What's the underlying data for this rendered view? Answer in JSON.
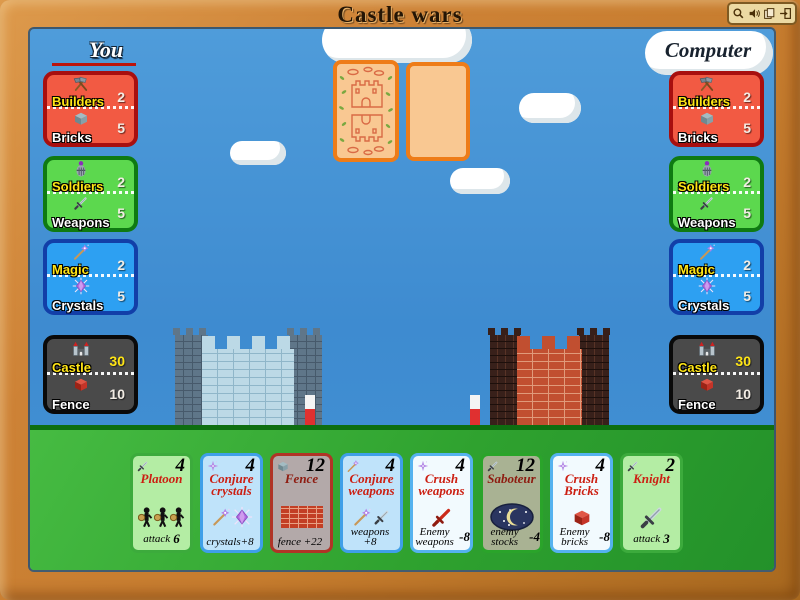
{
  "window": {
    "title": "Castle wars",
    "toolbar": {
      "zoom_icon": "magnifier",
      "sound_icon": "speaker",
      "pages_icon": "pages",
      "exit_icon": "exit-door"
    }
  },
  "players": {
    "you": {
      "name": "You",
      "panels": [
        {
          "icon_top": "builders-hammers-icon",
          "label_top": "Builders",
          "value_top": "2",
          "icon_bottom": "brick-icon",
          "label_bottom": "Bricks",
          "value_bottom": "5"
        },
        {
          "icon_top": "knight-helmet-icon",
          "label_top": "Soldiers",
          "value_top": "2",
          "icon_bottom": "sword-icon",
          "label_bottom": "Weapons",
          "value_bottom": "5"
        },
        {
          "icon_top": "magic-wand-icon",
          "label_top": "Magic",
          "value_top": "2",
          "icon_bottom": "crystal-icon",
          "label_bottom": "Crystals",
          "value_bottom": "5"
        },
        {
          "icon_top": "castle-icon",
          "label_top": "Castle",
          "value_top": "30",
          "icon_bottom": "fence-brick-icon",
          "label_bottom": "Fence",
          "value_bottom": "10"
        }
      ]
    },
    "computer": {
      "name": "Computer",
      "panels": [
        {
          "icon_top": "builders-hammers-icon",
          "label_top": "Builders",
          "value_top": "2",
          "icon_bottom": "brick-icon",
          "label_bottom": "Bricks",
          "value_bottom": "5"
        },
        {
          "icon_top": "knight-helmet-icon",
          "label_top": "Soldiers",
          "value_top": "2",
          "icon_bottom": "sword-icon",
          "label_bottom": "Weapons",
          "value_bottom": "5"
        },
        {
          "icon_top": "magic-wand-icon",
          "label_top": "Magic",
          "value_top": "2",
          "icon_bottom": "crystal-icon",
          "label_bottom": "Crystals",
          "value_bottom": "5"
        },
        {
          "icon_top": "castle-icon",
          "label_top": "Castle",
          "value_top": "30",
          "icon_bottom": "fence-brick-icon",
          "label_bottom": "Fence",
          "value_bottom": "10"
        }
      ]
    }
  },
  "hand": {
    "cards": [
      {
        "title": "Platoon",
        "cost": "4",
        "effect_main": "attack",
        "effect_value": "6",
        "type": "soldiers",
        "corner_icon": "sword-icon"
      },
      {
        "title": "Conjure crystals",
        "cost": "4",
        "effect_main": "crystals+8",
        "effect_value": "",
        "type": "magic",
        "corner_icon": "crystal-sparkle-icon"
      },
      {
        "title": "Fence",
        "cost": "12",
        "effect_main": "fence +22",
        "effect_value": "",
        "type": "builders",
        "corner_icon": "brick-icon"
      },
      {
        "title": "Conjure weapons",
        "cost": "4",
        "effect_main": "weapons +8",
        "effect_value": "",
        "type": "magic",
        "corner_icon": "magic-wand-icon"
      },
      {
        "title": "Crush weapons",
        "cost": "4",
        "effect_main": "Enemy weapons",
        "effect_value": "-8",
        "type": "magic",
        "corner_icon": "crystal-sparkle-icon"
      },
      {
        "title": "Saboteur",
        "cost": "12",
        "effect_main": "enemy stocks",
        "effect_value": "-4",
        "type": "soldiers",
        "corner_icon": "sword-icon"
      },
      {
        "title": "Crush Bricks",
        "cost": "4",
        "effect_main": "Enemy bricks",
        "effect_value": "-8",
        "type": "magic",
        "corner_icon": "crystal-sparkle-icon"
      },
      {
        "title": "Knight",
        "cost": "2",
        "effect_main": "attack",
        "effect_value": "3",
        "type": "soldiers",
        "corner_icon": "sword-icon"
      }
    ]
  },
  "colors": {
    "frame": "#c67c2e",
    "sky": "#3e8bd0",
    "ground": "#2fa22f",
    "panel_red": "#f25a43",
    "panel_green": "#5cd84e",
    "panel_blue": "#2da0f2",
    "panel_black": "#4a4a4a",
    "accent_yellow": "#ffe515",
    "card_title_red": "#cc1f12"
  }
}
